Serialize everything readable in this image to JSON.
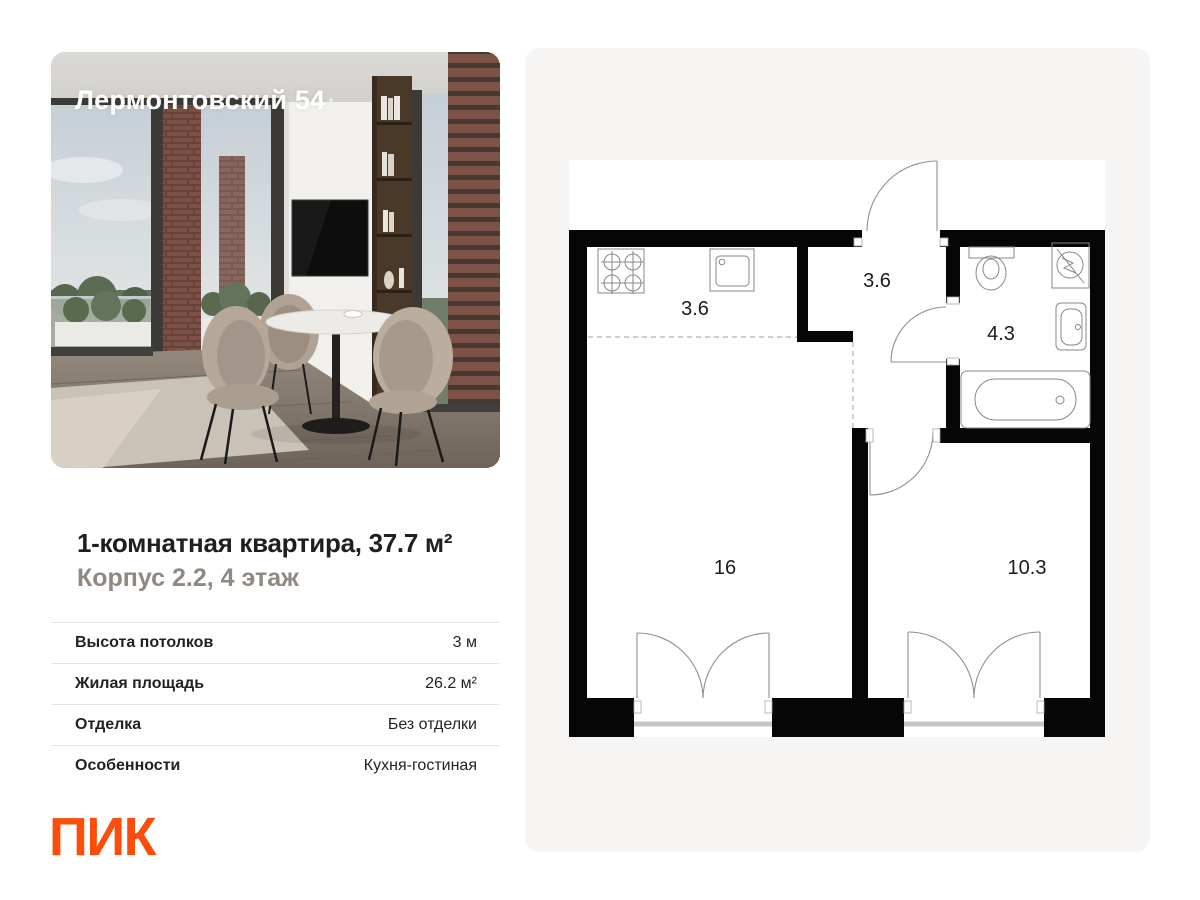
{
  "photo": {
    "overlay_title": "Лермонтовский 54"
  },
  "listing": {
    "title": "1-комнатная квартира, 37.7 м²",
    "subtitle": "Корпус 2.2, 4 этаж"
  },
  "details": {
    "rows": [
      {
        "label": "Высота потолков",
        "value": "3 м"
      },
      {
        "label": "Жилая площадь",
        "value": "26.2 м²"
      },
      {
        "label": "Отделка",
        "value": "Без отделки"
      },
      {
        "label": "Особенности",
        "value": "Кухня-гостиная"
      }
    ]
  },
  "brand": {
    "logo_text": "ПИК",
    "color": "#FB4E0A"
  },
  "floorplan": {
    "rooms": [
      {
        "id": "kitchen",
        "area_label": "3.6"
      },
      {
        "id": "hallway",
        "area_label": "3.6"
      },
      {
        "id": "bathroom",
        "area_label": "4.3"
      },
      {
        "id": "living-room",
        "area_label": "16"
      },
      {
        "id": "bedroom",
        "area_label": "10.3"
      }
    ],
    "fixtures": [
      "stove",
      "kitchen-sink",
      "toilet",
      "washing-machine",
      "bathroom-sink",
      "bathtub"
    ]
  }
}
